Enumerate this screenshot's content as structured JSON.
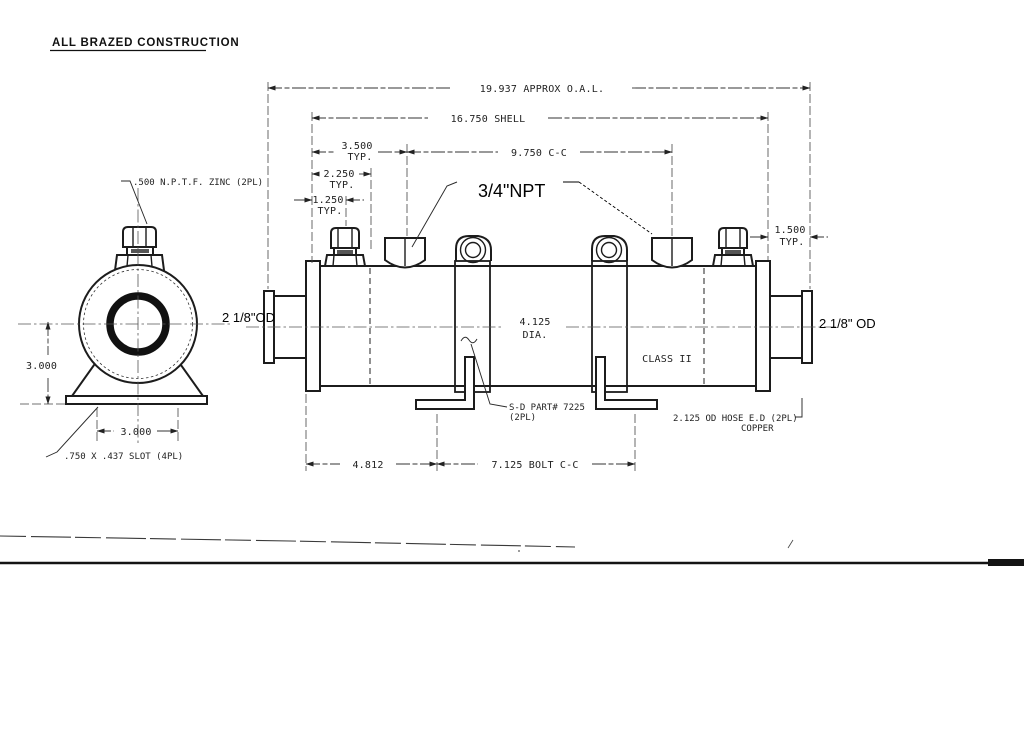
{
  "drawing": {
    "title": "ALL BRAZED CONSTRUCTION",
    "dims": {
      "oal": "19.937 APPROX O.A.L.",
      "shell": "16.750 SHELL",
      "port_cc": "9.750 C-C",
      "d3500": "3.500",
      "d2250": "2.250",
      "d1250": "1.250",
      "d1500": "1.500",
      "typ": "TYP.",
      "dia": "4.125",
      "dia_suffix": "DIA.",
      "end_height": "3.000",
      "slot_cc": "3.000",
      "d4812": "4.812",
      "bolt_cc": "7.125 BOLT C-C"
    },
    "notes": {
      "zinc": ".500 N.P.T.F. ZINC (2PL)",
      "slot": ".750 X .437 SLOT (4PL)",
      "class_rating": "CLASS II",
      "part1": "S-D PART# 7225",
      "part2": "(2PL)",
      "hose1": "2.125 OD HOSE E.D (2PL)",
      "hose2": "COPPER"
    },
    "added_annotations": {
      "npt": "3/4\"NPT",
      "od_left": "2 1/8\"OD",
      "od_right": "2 1/8\" OD"
    }
  }
}
